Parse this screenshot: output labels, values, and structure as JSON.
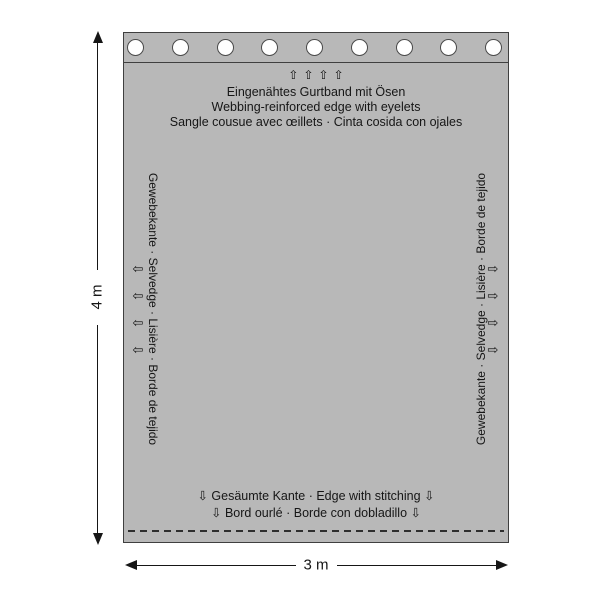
{
  "colors": {
    "fabric": "#b8b8b8",
    "outline": "#3f3f3f",
    "eyelet_fill": "#ffffff",
    "text": "#161616"
  },
  "top_edge": {
    "eyelet_count": 9,
    "arrow_glyph": "⇧",
    "arrow_count": 4,
    "labels": [
      "Eingenähtes Gurtband mit Ösen",
      "Webbing-reinforced edge with eyelets",
      "Sangle cousue avec œillets · Cinta cosida con ojales"
    ]
  },
  "left_edge": {
    "label": "Gewebekante · Selvedge · Lisière · Borde de tejido",
    "arrow_glyph": "⇦",
    "arrow_count": 4
  },
  "right_edge": {
    "label": "Gewebekante · Selvedge · Lisière · Borde de tejido",
    "arrow_glyph": "⇨",
    "arrow_count": 4
  },
  "bottom_edge": {
    "labels": [
      "⇩ Gesäumte Kante · Edge with stitching ⇩",
      "⇩ Bord ourlé · Borde con dobladillo ⇩"
    ]
  },
  "dimensions": {
    "height_label": "4 m",
    "width_label": "3 m"
  }
}
